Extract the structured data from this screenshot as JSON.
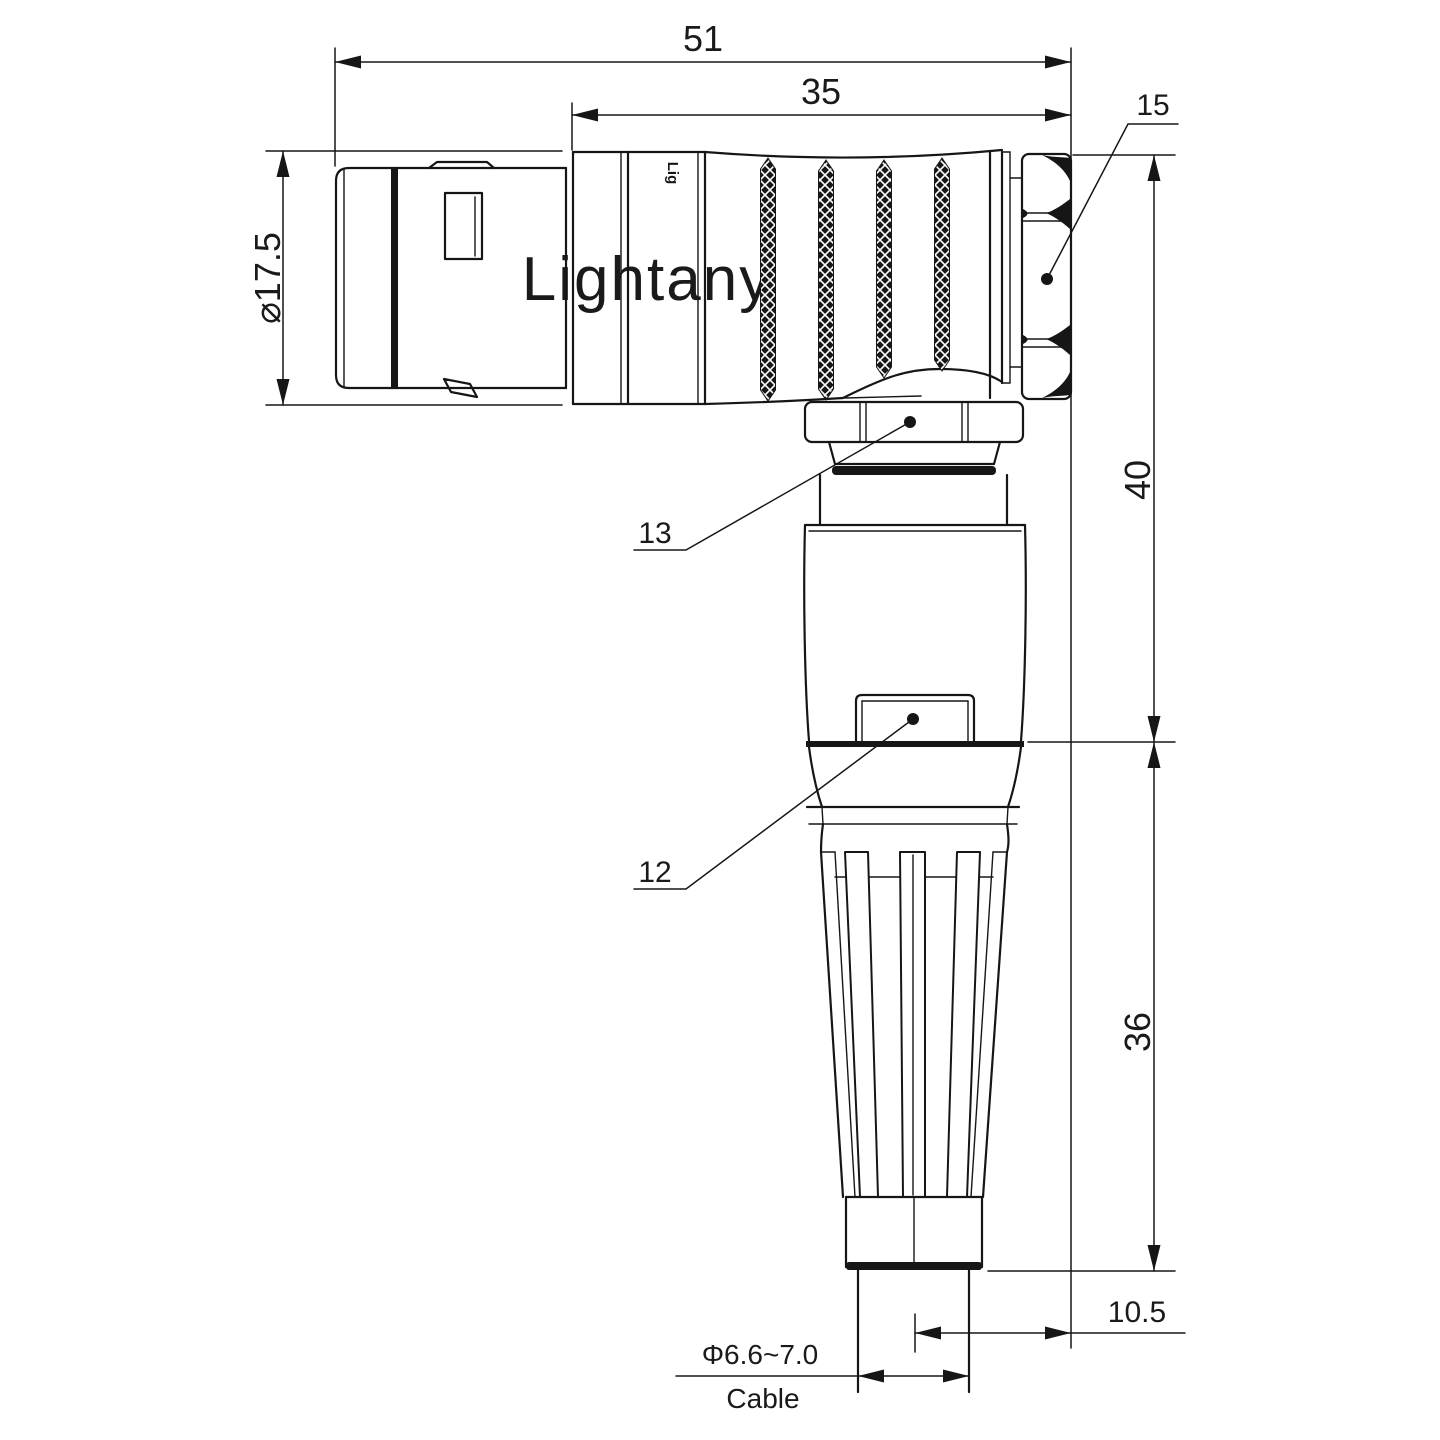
{
  "drawing": {
    "watermark": "Lightany",
    "body_mark": "Lig",
    "colors": {
      "line": "#161616",
      "watermark": "#f2cbcb"
    },
    "dims": {
      "overall_length": "51",
      "rear_length": "35",
      "backnut_ref": "15",
      "front_diameter": "⌀17.5",
      "elbow_height": "40",
      "boot_height": "36",
      "axis_offset": "10.5",
      "cable_diameter": "Φ6.6~7.0",
      "cable_label": "Cable",
      "coupling_ref": "13",
      "housing_ref": "12"
    }
  }
}
